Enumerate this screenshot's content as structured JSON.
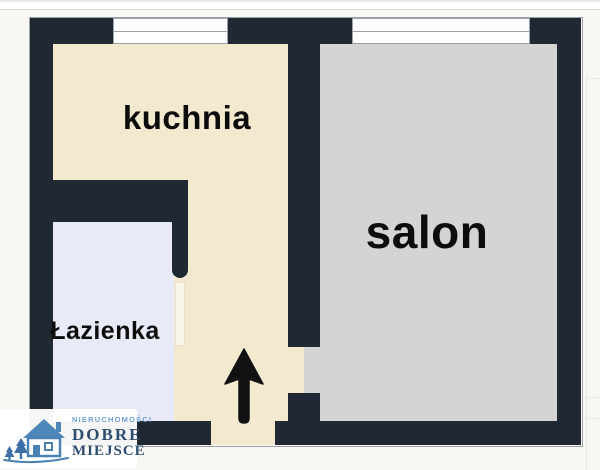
{
  "page": {
    "type": "apartment-floor-plan"
  },
  "rooms": {
    "kitchen": {
      "label": "kuchnia"
    },
    "living_room": {
      "label": "salon"
    },
    "bathroom": {
      "label": "Łazienka"
    }
  },
  "logo": {
    "tagline": "NIERUCHOMOŚCI",
    "name_line1": "DOBRE",
    "name_line2": "MIEJSCE"
  },
  "icons": {
    "entrance_arrow": "up-arrow",
    "window": "double-line-window-symbol",
    "logo_house": "house-with-pine-trees",
    "bathroom_door": "open-door-leaf"
  },
  "colors": {
    "background": "#f8f7f4",
    "wall": "#202834",
    "outline": "#9aa2aa",
    "kitchen_floor": "#f3e9cf",
    "salon_floor": "#d4d4d2",
    "bathroom_floor": "#e8ebf7",
    "window_fill": "#fdfdfd",
    "window_line": "#9aa3ad",
    "label_text": "#0c0c0c",
    "arrow": "#111111",
    "logo_blue": "#4a82b4",
    "logo_roof": "#4d86b8",
    "logo_tree": "#3c6ea8",
    "logo_blue_dark": "#2d4c6e",
    "logo_blue_light": "#6f9fd2"
  }
}
